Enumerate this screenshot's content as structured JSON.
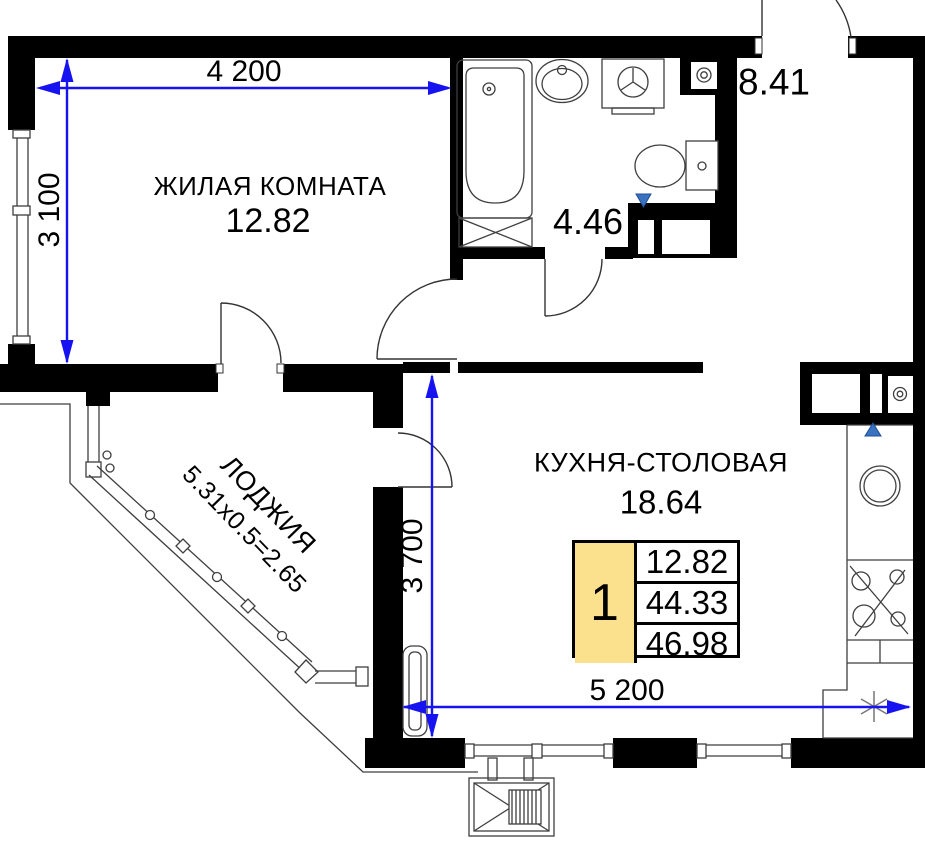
{
  "plan": {
    "title": "Apartment floor plan (1-room)",
    "rooms": {
      "living": {
        "name": "ЖИЛАЯ КОМНАТА",
        "area": "12.82"
      },
      "kitchen": {
        "name": "КУХНЯ-СТОЛОВАЯ",
        "area": "18.64"
      },
      "loggia": {
        "name": "ЛОДЖИЯ",
        "calc": "5.31x0.5=2.65"
      },
      "bathroom": {
        "area": "4.46"
      },
      "hall": {
        "area": "8.41"
      }
    },
    "dimensions": {
      "top": "4 200",
      "left": "3 100",
      "middle": "3 700",
      "bottom": "5 200"
    },
    "info_table": {
      "rooms": "1",
      "values": [
        "12.82",
        "44.33",
        "46.98"
      ]
    },
    "colors": {
      "dimension_blue": "#1613f0",
      "table_highlight": "#fbe08d",
      "vent_marker": "#3a72c0"
    }
  }
}
